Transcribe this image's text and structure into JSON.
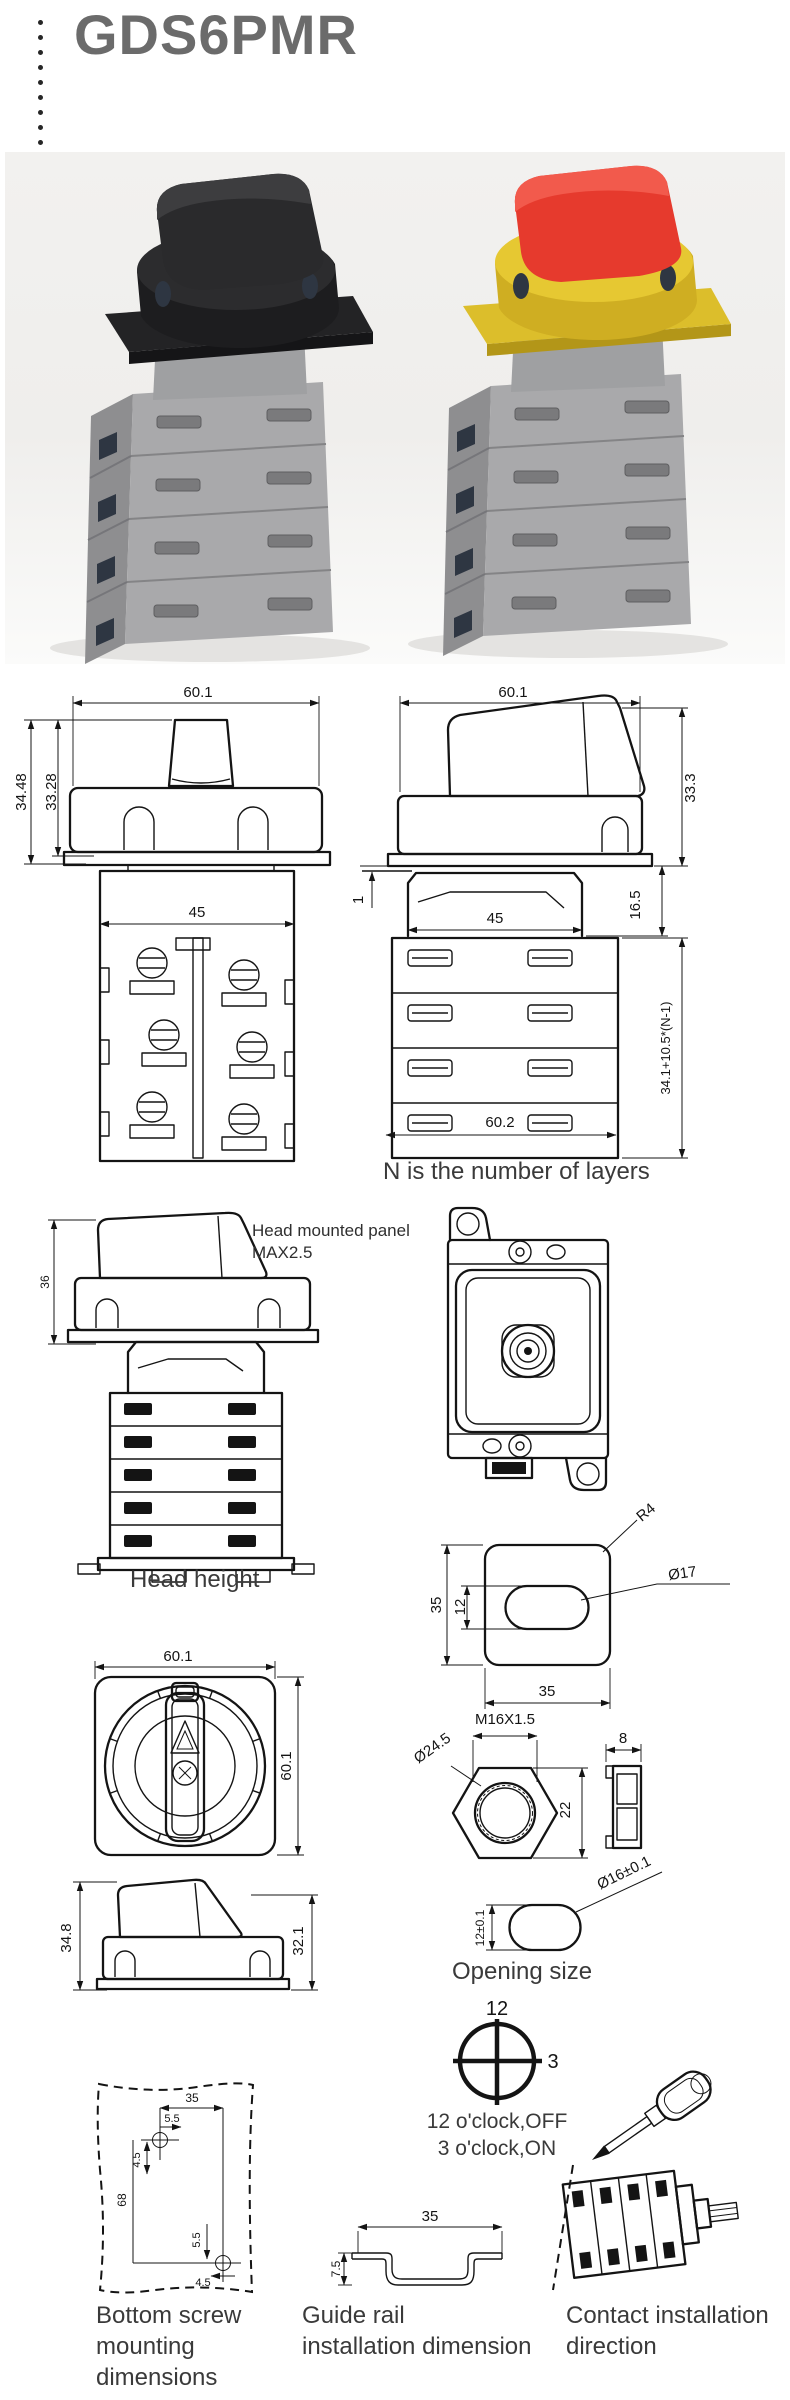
{
  "header": {
    "title": "GDS6PMR"
  },
  "figures": {
    "front_view": {
      "w": "60.1",
      "h1": "34.48",
      "h2": "33.28",
      "body": "45"
    },
    "side_view": {
      "w": "60.1",
      "h": "33.3",
      "panel": "1",
      "body": "45",
      "neck": "16.5",
      "stack": "34.1+10.5*(N-1)",
      "base": "60.2",
      "note": "N is the number of layers"
    },
    "head_height": {
      "h": "36",
      "note1": "Head mounted panel",
      "note2": "MAX2.5",
      "caption": "Head height"
    },
    "panel_cutout": {
      "outer_h": "35",
      "hole_h": "12",
      "outer_w": "35",
      "r": "R4",
      "dia": "Ø17"
    },
    "top_view": {
      "w": "60.1",
      "h": "60.1"
    },
    "nut": {
      "thread": "M16X1.5",
      "od": "Ø24.5",
      "flats": "22",
      "thk": "8"
    },
    "head_side": {
      "l": "34.8",
      "r": "32.1"
    },
    "opening": {
      "h": "12±0.1",
      "dia": "Ø16±0.1",
      "caption": "Opening size"
    },
    "clock": {
      "twelve": "12",
      "three": "3",
      "line1": "12 o'clock,OFF",
      "line2": "3 o'clock,ON"
    },
    "bottom_screw": {
      "top": "35",
      "top_off": "5.5",
      "left_off": "4.5",
      "h": "68",
      "bot_off": "5.5",
      "bot_edge": "4.5",
      "cap1": "Bottom screw",
      "cap2": "mounting",
      "cap3": "dimensions"
    },
    "guide_rail": {
      "w": "35",
      "h": "7.5",
      "cap1": "Guide rail",
      "cap2": "installation dimension"
    },
    "contact": {
      "cap1": "Contact installation",
      "cap2": "direction"
    }
  },
  "colors": {
    "title_gray": "#6b6b6b",
    "line_black": "#141414",
    "caption_gray": "#3a3a3a",
    "photo_bg": "#f1f0ee",
    "body_gray": "#a9a9ab",
    "knob_black": "#2a2a2c",
    "knob_red": "#e63a2d",
    "collar_yellow": "#e6c832"
  }
}
